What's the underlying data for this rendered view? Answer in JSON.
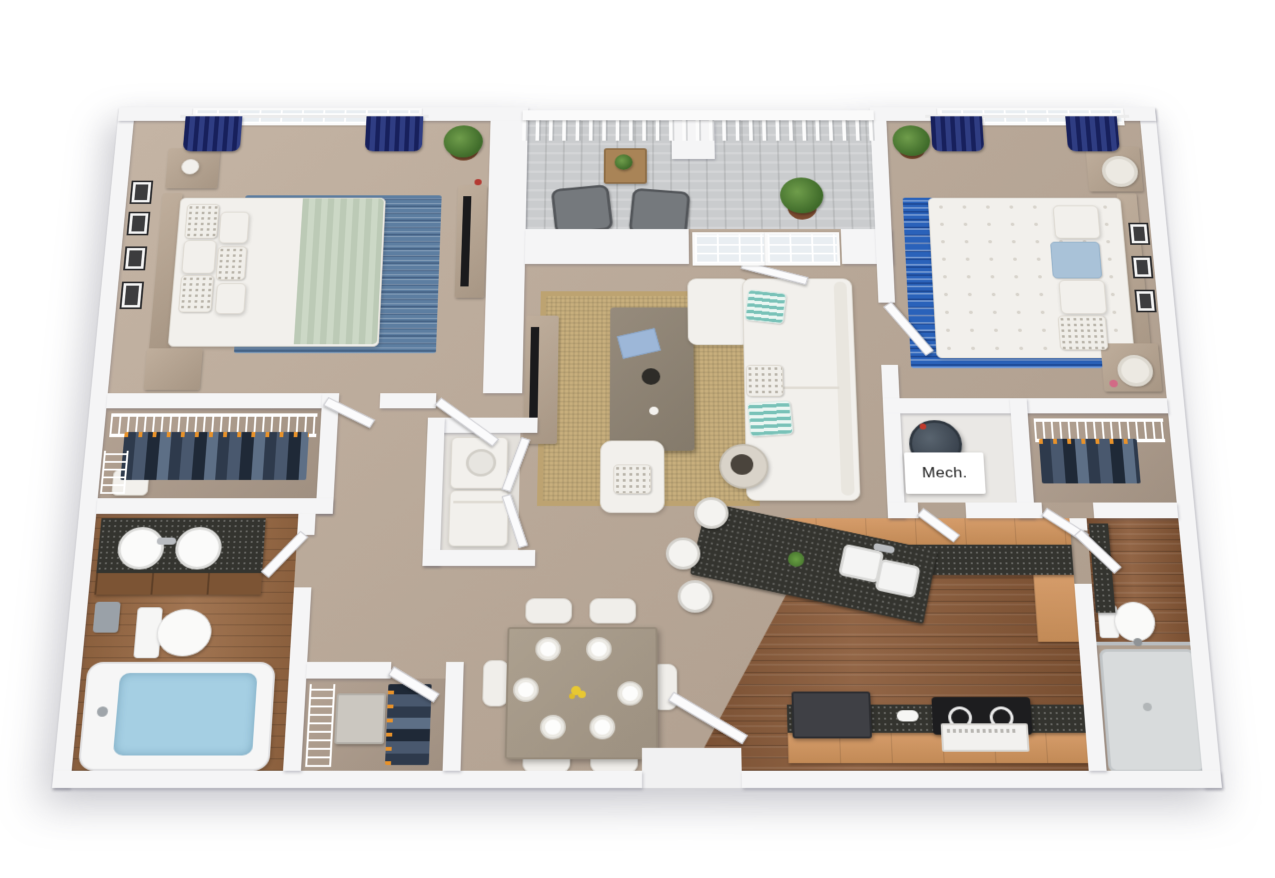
{
  "image": {
    "type": "3d-floor-plan-rendering",
    "view": "top-down dollhouse",
    "background": "#ffffff"
  },
  "labels": {
    "mech_room": "Mech."
  },
  "palette": {
    "wall": "#f5f5f6",
    "carpet": "#b8a797",
    "hardwood": "#8a5a38",
    "balcony_deck": "#caccce",
    "granite_counter": "#34342f",
    "cabinet_wood": "#cc9460",
    "curtain_navy": "#1c2566",
    "bedroom1_rug_blue": "#5d7ea1",
    "bedroom2_rug_blue": "#2a62ba",
    "jute_rug": "#c8af7d",
    "sofa_white": "#f2f0ec",
    "pillow_teal": "#79c2b8",
    "tub_water": "#a5cfe3",
    "throw_sage": "#bccab6",
    "plant_green": "#4e7d3a",
    "hanger_orange": "#e8922a"
  },
  "rooms": [
    {
      "id": "bedroom-1",
      "name": "Bedroom 1",
      "floor": "carpet",
      "furniture": [
        "queen bed with sage throw",
        "headboard",
        "two nightstands",
        "dresser with tv",
        "blue area rug",
        "four framed pictures",
        "potted plant",
        "window with navy curtains"
      ]
    },
    {
      "id": "balcony",
      "name": "Balcony",
      "floor": "deck planks",
      "furniture": [
        "two patio chairs",
        "wood side table with plant",
        "potted palm",
        "picket railing"
      ]
    },
    {
      "id": "living-room",
      "name": "Living Room",
      "floor": "carpet",
      "furniture": [
        "white sectional sofa with chaise",
        "teal striped pillows",
        "coffee table",
        "tv console with tv",
        "armchair",
        "round drum side table",
        "jute rug",
        "french doors to balcony"
      ]
    },
    {
      "id": "bedroom-2",
      "name": "Bedroom 2",
      "floor": "carpet",
      "furniture": [
        "queen bed with leaf-print duvet",
        "light blue pillows",
        "two nightstands with lamps",
        "bright blue area rug",
        "three framed pictures",
        "potted plant",
        "window with navy curtains"
      ]
    },
    {
      "id": "walk-in-closet-1",
      "name": "Walk-in Closet",
      "floor": "carpet",
      "furniture": [
        "wire shelving",
        "hanging clothes",
        "hamper"
      ]
    },
    {
      "id": "bathroom-1",
      "name": "Bathroom",
      "floor": "hardwood",
      "furniture": [
        "double vanity with two sinks",
        "toilet",
        "bathtub with water"
      ]
    },
    {
      "id": "closet-2",
      "name": "Closet",
      "floor": "carpet",
      "furniture": [
        "wire shelving",
        "hanging clothes",
        "storage chest"
      ]
    },
    {
      "id": "laundry-closet",
      "name": "Laundry Closet",
      "floor": "vinyl",
      "furniture": [
        "stacked washer and dryer",
        "bifold doors"
      ]
    },
    {
      "id": "dining-area",
      "name": "Dining Area",
      "floor": "carpet",
      "furniture": [
        "dining table with six place settings",
        "six white chairs",
        "yellow flower centerpiece"
      ]
    },
    {
      "id": "kitchen",
      "name": "Kitchen",
      "floor": "hardwood",
      "furniture": [
        "angled breakfast bar with double sink",
        "three bar stools",
        "granite counters",
        "wood cabinets",
        "refrigerator",
        "range with oven"
      ]
    },
    {
      "id": "mech-room",
      "name": "Mechanical Room",
      "floor": "vinyl",
      "furniture": [
        "water heater"
      ],
      "label": "Mech."
    },
    {
      "id": "walk-in-closet-3",
      "name": "Walk-in Closet",
      "floor": "carpet",
      "furniture": [
        "wire shelving",
        "hanging clothes"
      ]
    },
    {
      "id": "bathroom-2",
      "name": "Bathroom",
      "floor": "hardwood",
      "furniture": [
        "vanity",
        "toilet",
        "walk-in shower with glass door"
      ]
    },
    {
      "id": "entry",
      "name": "Entry",
      "floor": "threshold",
      "furniture": [
        "front door"
      ]
    }
  ]
}
